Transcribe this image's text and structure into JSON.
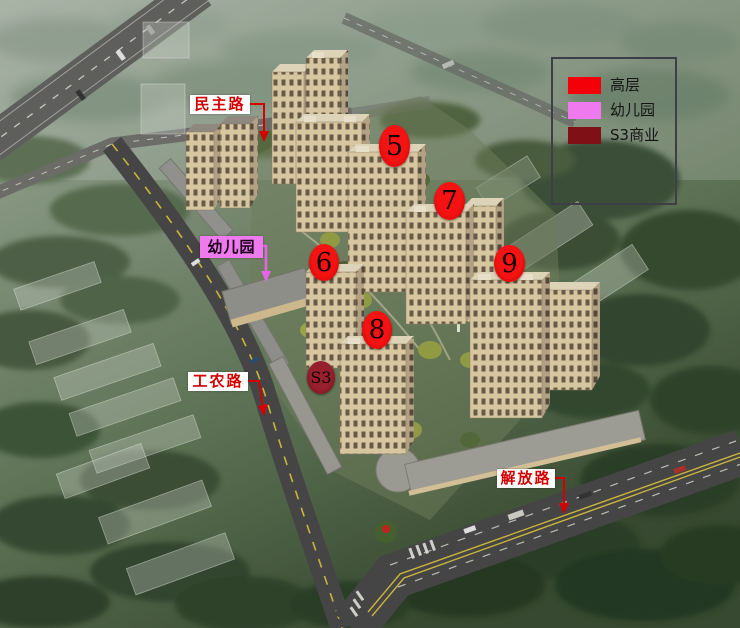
{
  "image": {
    "kind": "aerial-rendering-of-residential-development",
    "width": 740,
    "height": 628
  },
  "annotations": {
    "roads": {
      "minzhu": {
        "text": "民主路"
      },
      "gongnong": {
        "text": "工农路"
      },
      "jiefang": {
        "text": "解放路"
      }
    },
    "kindergarten": {
      "text": "幼儿园"
    },
    "markers": {
      "m5": "5",
      "m6": "6",
      "m7": "7",
      "m8": "8",
      "m9": "9",
      "s3": "S3"
    }
  },
  "legend": {
    "items": [
      {
        "label": "高层",
        "color": "#f40008"
      },
      {
        "label": "幼儿园",
        "color": "#ee7aee"
      },
      {
        "label": "S3商业",
        "color": "#7e1016"
      }
    ]
  },
  "colors": {
    "marker_red": "#ee0404",
    "marker_maroon": "#8a1824",
    "label_red": "#d40000",
    "label_violet": "#ee7aee",
    "label_bg": "#ffffff"
  }
}
